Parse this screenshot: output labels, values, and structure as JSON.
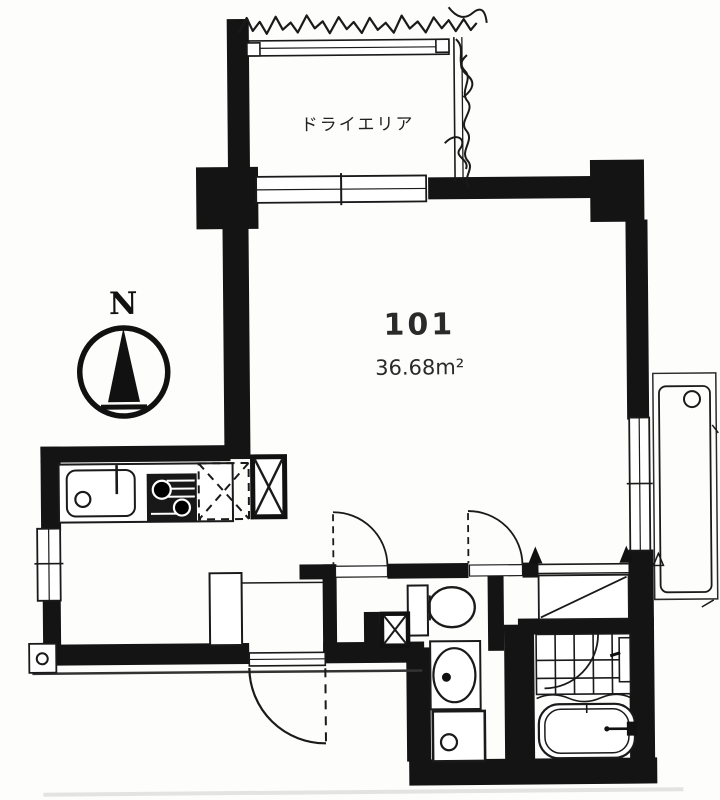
{
  "plan": {
    "unit_number": "101",
    "area": "36.68m²",
    "labels": {
      "dry_area": "ドライエリア",
      "compass_north": "N"
    },
    "colors": {
      "ink": "#141414",
      "paper": "#fdfdfc"
    },
    "fixture_icons": [
      "kitchen-sink-icon",
      "gas-stove-icon",
      "refrigerator-space-icon",
      "duct-shaft-icon",
      "toilet-icon",
      "washbasin-icon",
      "washing-machine-pan-icon",
      "bathtub-icon",
      "shower-tile-floor-icon",
      "closet-icon",
      "shoe-cabinet-icon",
      "entrance-door-icon",
      "compass-north-icon",
      "window-icon",
      "service-pad-icon",
      "ground-hatch-icon"
    ]
  }
}
